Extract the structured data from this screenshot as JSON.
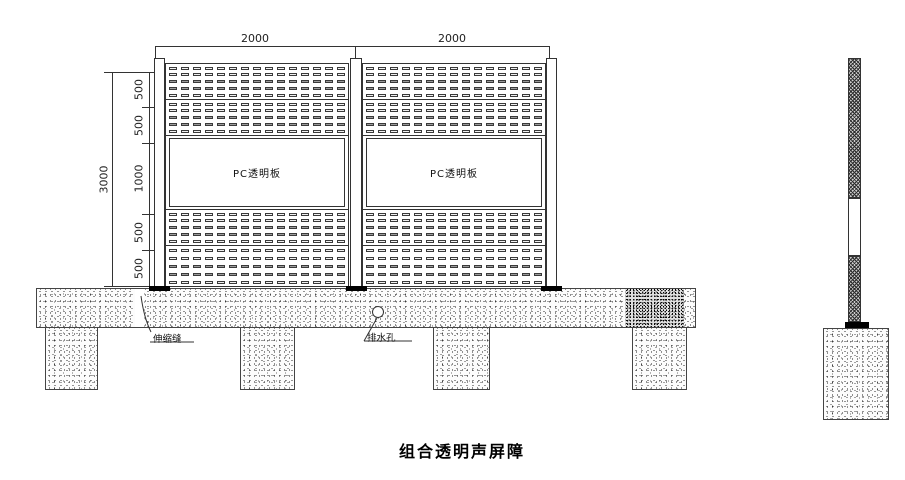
{
  "drawing_title": "组合透明声屏障",
  "front_view": {
    "top_width_dims": [
      "2000",
      "2000"
    ],
    "overall_height_dim": "3000",
    "segment_height_dims": [
      "500",
      "500",
      "1000",
      "500",
      "500"
    ],
    "panels": [
      {
        "pc_label": "PC透明板"
      },
      {
        "pc_label": "PC透明板"
      }
    ],
    "annotations": {
      "expansion_joint": "伸缩缝",
      "drain_hole": "排水孔"
    }
  },
  "colors": {
    "line": "#333333",
    "pad_black": "#000000",
    "slot_border": "#3a3a3a",
    "slot_accent_fill": "#9b9b9b",
    "hatch": "#2e2e2e"
  }
}
